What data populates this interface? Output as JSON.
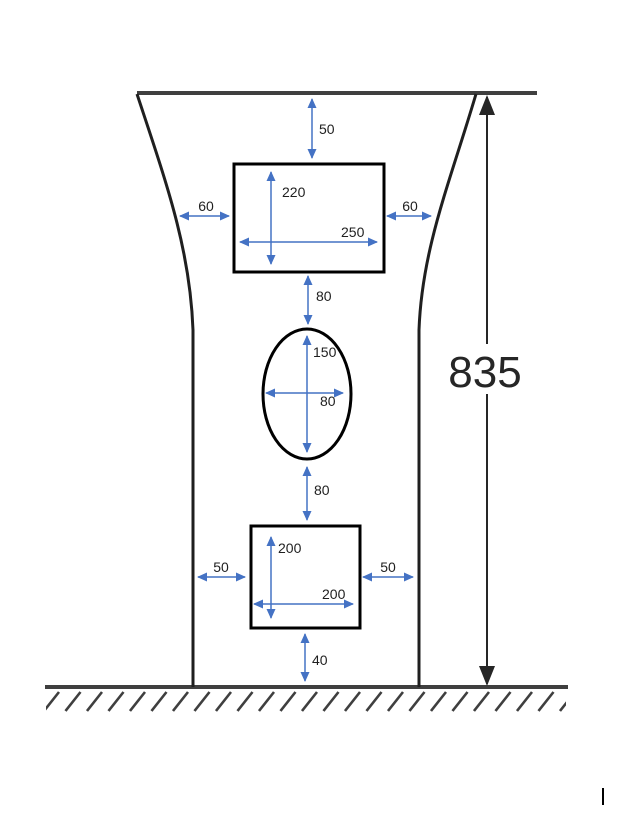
{
  "diagram": {
    "overall_height_label": "835",
    "top_gap_label": "50",
    "top_rectangle": {
      "height_label": "220",
      "width_label": "250",
      "left_gap_label": "60",
      "right_gap_label": "60"
    },
    "gap_rect_to_ellipse_label": "80",
    "ellipse": {
      "height_label": "150",
      "width_label": "80"
    },
    "gap_ellipse_to_square_label": "80",
    "bottom_square": {
      "height_label": "200",
      "width_label": "200",
      "left_gap_label": "50",
      "right_gap_label": "50",
      "bottom_gap_label": "40"
    }
  },
  "colors": {
    "dimension_blue": "#4472C4",
    "outline_black": "#1f1f1f",
    "ground_gray": "#3f3f3f"
  }
}
